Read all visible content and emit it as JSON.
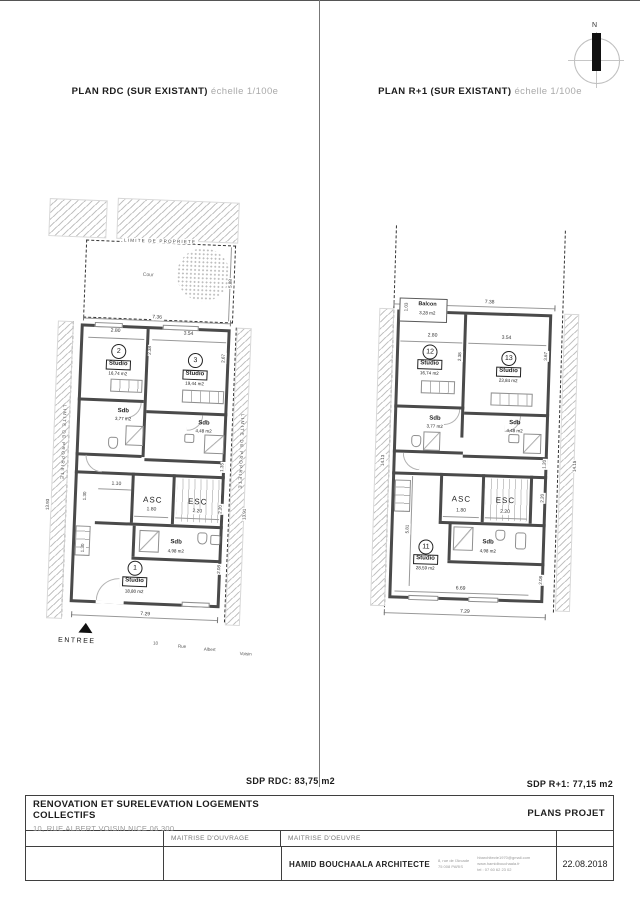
{
  "north": {
    "label": "N"
  },
  "rdc": {
    "title": "PLAN RDC (SUR EXISTANT)",
    "scale": "échelle 1/100e",
    "limite_top": "LIMITE DE PROPRIETE",
    "limite_left": "LIMITE DE PROPRIETE",
    "limite_right": "LIMITE DE PROPRIETE",
    "cour": "Cour",
    "entree": "ENTREE",
    "street": [
      "10",
      "Rue",
      "Albert",
      "Voisin"
    ],
    "room2": {
      "num": "2",
      "label": "Studio",
      "area": "16,74 m2"
    },
    "room3": {
      "num": "3",
      "label": "Studio",
      "area": "19,44 m2"
    },
    "room1": {
      "num": "1",
      "label": "Studio",
      "area": "18,80 m2"
    },
    "sdb2": {
      "label": "Sdb",
      "area": "3,77 m2"
    },
    "sdb3": {
      "label": "Sdb",
      "area": "4,48 m2"
    },
    "sdb1": {
      "label": "Sdb",
      "area": "4,98 m2"
    },
    "asc": {
      "label": "ASC",
      "dim": "1.80"
    },
    "esc": {
      "label": "ESC",
      "dim": "2.20"
    },
    "dims": {
      "cour_w": "7.36",
      "cour_h": "5.88",
      "r2_w": "2.80",
      "r3_w": "3.54",
      "div_h": "2.38",
      "r3_h": "2.67",
      "hall": "1.10",
      "left_a": "1.30",
      "left_b": "1.30",
      "right_a": "1.35",
      "right_b": "2.20",
      "right_c": "2.08",
      "bottom": "7.29",
      "side_left": "13.93",
      "side_right": "13.91"
    }
  },
  "r1": {
    "title": "PLAN R+1 (SUR EXISTANT)",
    "scale": "échelle 1/100e",
    "balcon": {
      "label": "Balcon",
      "area": "3,28 m2",
      "dim": "1.03"
    },
    "room12": {
      "num": "12",
      "label": "Studio",
      "area": "16,74 m2"
    },
    "room13": {
      "num": "13",
      "label": "Studio",
      "area": "23,84 m2"
    },
    "room11": {
      "num": "11",
      "label": "Studio",
      "area": "28,59 m2"
    },
    "sdb12": {
      "label": "Sdb",
      "area": "3,77 m2"
    },
    "sdb13": {
      "label": "Sdb",
      "area": "4,48 m2"
    },
    "sdb11": {
      "label": "Sdb",
      "area": "4,98 m2"
    },
    "asc": {
      "label": "ASC",
      "dim": "1.80"
    },
    "esc": {
      "label": "ESC",
      "dim": "2.20"
    },
    "dims": {
      "top": "7.38",
      "balcon_h": "1.03",
      "r12_w": "2.80",
      "r13_w": "3.54",
      "div_h": "2.38",
      "r13_h": "3.67",
      "right_a": "1.20",
      "right_b": "2.20",
      "right_c": "2.08",
      "left_a": "5.81",
      "inner": "6.69",
      "bottom": "7.29",
      "side_left": "14.13",
      "side_right": "14.15"
    }
  },
  "footer": {
    "sdp_rdc": "SDP RDC: 83,75 m2",
    "sdp_r1": "SDP R+1: 77,15 m2"
  },
  "titleblock": {
    "project": "RENOVATION ET SURELEVATION LOGEMENTS COLLECTIFS",
    "address": "10, RUE ALBERT VOISIN NICE 06 300",
    "doc": "PLANS PROJET",
    "mo": "MAITRISE D'OUVRAGE",
    "moe": "MAITRISE D'OEUVRE",
    "architect": "HAMID BOUCHAALA ARCHITECTE",
    "arch_addr1": "8, rue de l'Arcade",
    "arch_addr2": "75 008 PARIS",
    "arch_email": "hbarchitecte1970@gmail.com",
    "arch_web": "www.hamidbouchaala.fr",
    "arch_tel": "tel : 07 60 62 23 02",
    "date": "22.08.2018"
  }
}
